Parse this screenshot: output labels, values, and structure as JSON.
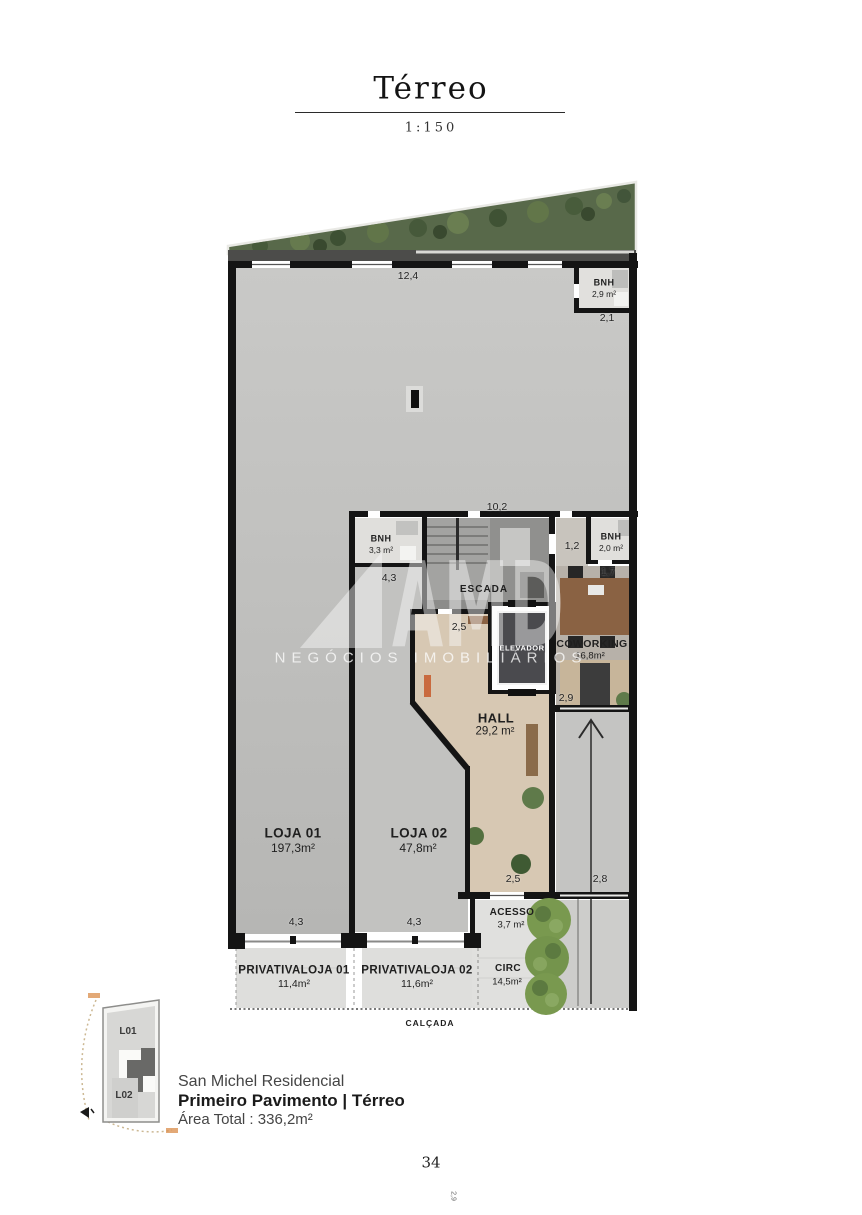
{
  "title_block": {
    "title": "Térreo",
    "scale": "1:150"
  },
  "watermark": {
    "logo": "AMD",
    "subtitle": "NEGÓCIOS IMOBILIÁRIOS"
  },
  "plan": {
    "rooms": [
      {
        "name": "BNH",
        "area": "2,9 m²"
      },
      {
        "name": "BNH",
        "area": "3,3 m²"
      },
      {
        "name": "ESCADA",
        "area": ""
      },
      {
        "name": "ELEVADOR",
        "area": ""
      },
      {
        "name": "BNH",
        "area": "2,0 m²"
      },
      {
        "name": "COWORKING",
        "area": "16,8m²"
      },
      {
        "name": "HALL",
        "area": "29,2 m²"
      },
      {
        "name": "LOJA 01",
        "area": "197,3m²"
      },
      {
        "name": "LOJA 02",
        "area": "47,8m²"
      },
      {
        "name": "ACESSO",
        "area": "3,7 m²"
      },
      {
        "name": "CIRC",
        "area": "14,5m²"
      },
      {
        "name": "PRIVATIVALOJA 01",
        "area": "11,4m²"
      },
      {
        "name": "PRIVATIVALOJA 02",
        "area": "11,6m²"
      }
    ],
    "dims": [
      "12,4",
      "2,1",
      "10,2",
      "4,3",
      "2,5",
      "1,2",
      "1,7",
      "2,9",
      "2,5",
      "2,8",
      "4,3",
      "4,3"
    ],
    "street_label": "CALÇADA"
  },
  "keyplan": {
    "units": [
      "L01",
      "L02"
    ]
  },
  "footer": {
    "project": "San Michel Residencial",
    "floor_title": "Primeiro Pavimento | Térreo",
    "total_area": "Área Total : 336,2m²",
    "page_number": "34",
    "margin_note": "2,9"
  }
}
